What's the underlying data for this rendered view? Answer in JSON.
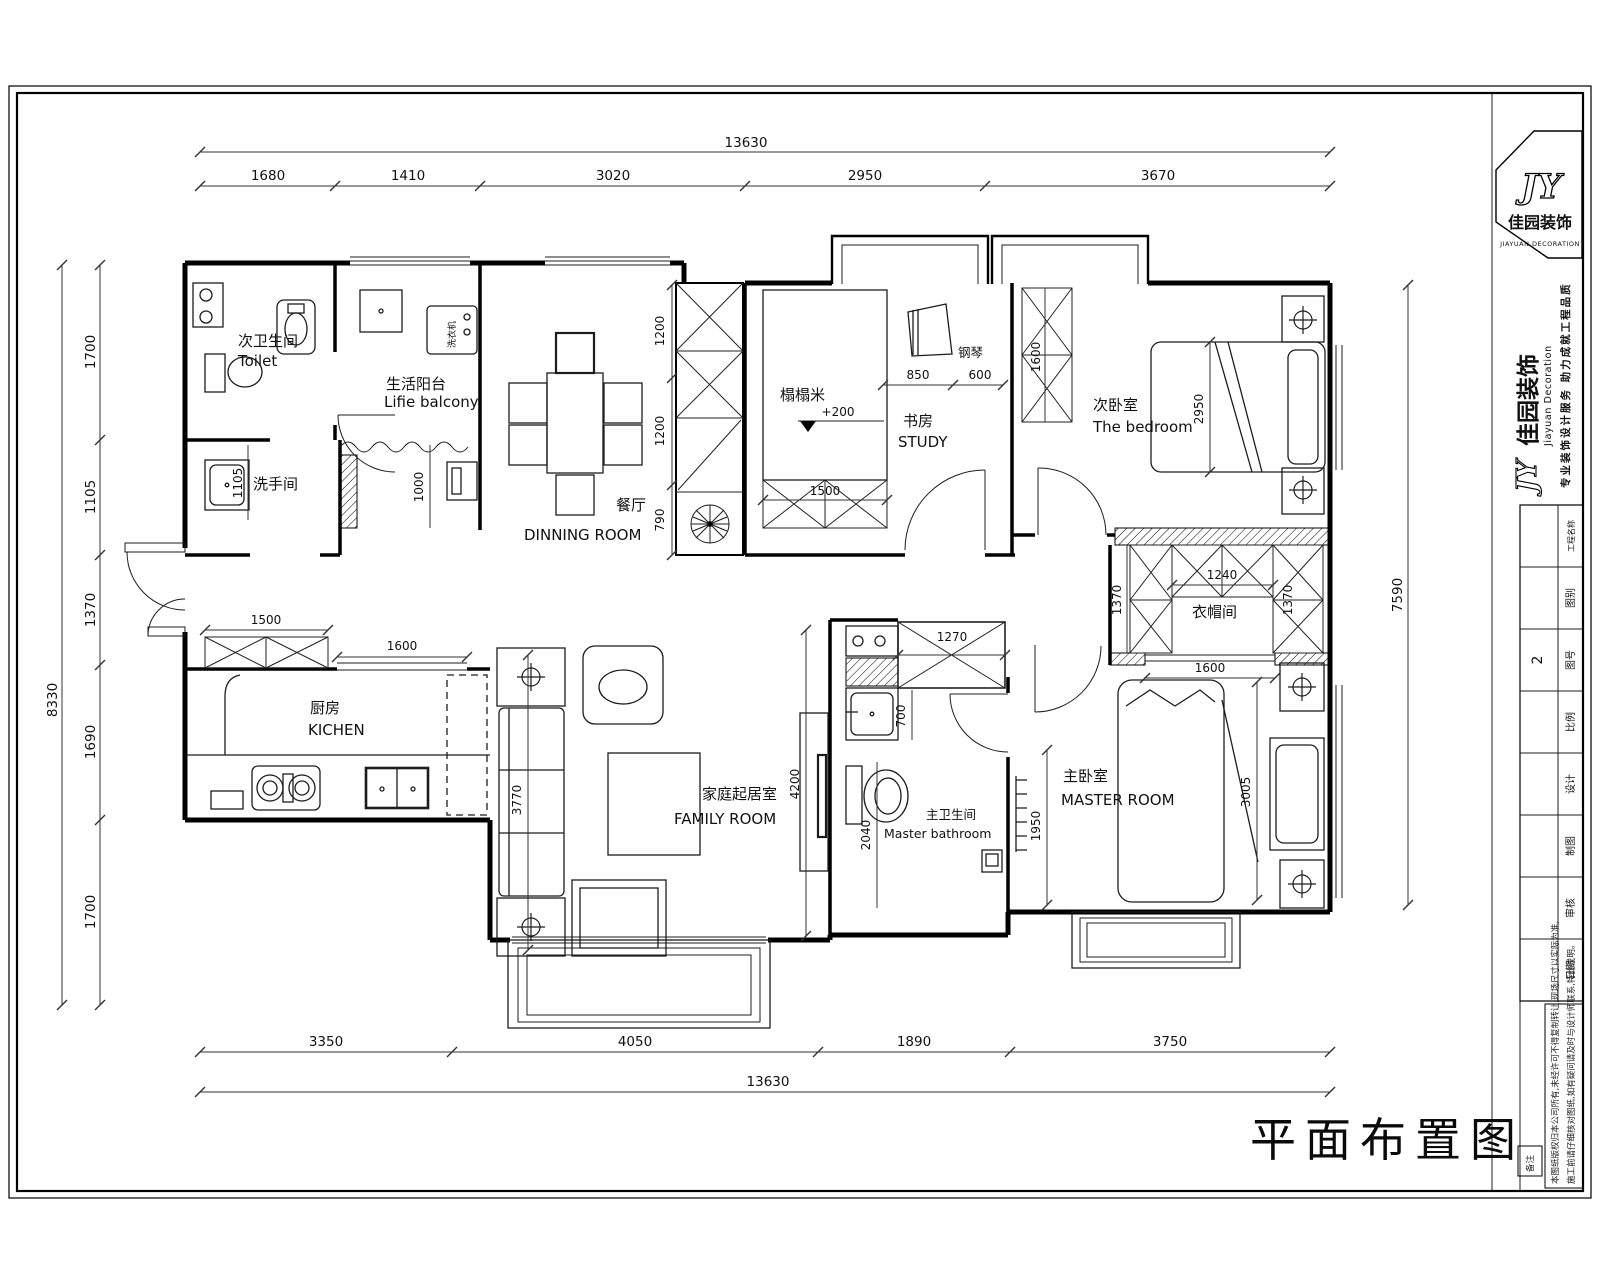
{
  "sheet": {
    "title": "平面布置图"
  },
  "logo": {
    "monogram": "JY",
    "name_cn": "佳园装饰",
    "name_en": "JIAYUAN DECORATION"
  },
  "brand": {
    "monogram": "JY",
    "name_cn": "佳园装饰",
    "name_en": "Jiayuan Decoration",
    "slogan": "专业装饰设计服务 助力成就工程品质"
  },
  "titleblock": {
    "rows": [
      {
        "label": "工程名称",
        "value": ""
      },
      {
        "label": "图别",
        "value": ""
      },
      {
        "label": "图号",
        "value": "2"
      },
      {
        "label": "比例",
        "value": ""
      },
      {
        "label": "设计",
        "value": ""
      },
      {
        "label": "制图",
        "value": ""
      },
      {
        "label": "审核",
        "value": ""
      },
      {
        "label": "日期",
        "value": ""
      }
    ],
    "note_box": "备注",
    "notes1": "本图纸版权归本公司所有,未经许可不得复制转让,现场尺寸以实际为准,",
    "notes2": "施工前请仔细核对图纸,如有疑问请及时与设计师联系,特此说明。"
  },
  "rooms": {
    "toilet_cn": "次卫生间",
    "toilet_en": "Toilet",
    "balcony_cn": "生活阳台",
    "balcony_en": "Lifie balcony",
    "washer": "洗衣机",
    "washroom_cn": "洗手间",
    "dining_cn": "餐厅",
    "dining_en": "DINNING ROOM",
    "study_cn": "书房",
    "study_en": "STUDY",
    "tatami": "榻榻米",
    "piano": "钢琴",
    "bedroom2_cn": "次卧室",
    "bedroom2_en": "The bedroom",
    "closet_cn": "衣帽间",
    "kitchen_cn": "厨房",
    "kitchen_en": "KICHEN",
    "family_cn": "家庭起居室",
    "family_en": "FAMILY ROOM",
    "mbath_cn": "主卫生间",
    "mbath_en": "Master bathroom",
    "master_cn": "主卧室",
    "master_en": "MASTER ROOM"
  },
  "dims": {
    "top_total": "13630",
    "top": [
      "1680",
      "1410",
      "3020",
      "2950",
      "3670"
    ],
    "bottom": [
      "3350",
      "4050",
      "1890",
      "3750"
    ],
    "bottom_total": "13630",
    "left_total": "8330",
    "left": [
      "1700",
      "1105",
      "1370",
      "1690",
      "1700"
    ],
    "right_total": "7590",
    "interior": {
      "stair1": "1200",
      "stair2": "1200",
      "stair3": "790",
      "wash": "1105",
      "balcony": "1000",
      "study_a": "850",
      "study_b": "600",
      "study_cab": "1500",
      "wardrobe": "1600",
      "window_bed2": "2950",
      "closet_top": "1240",
      "closet_left": "1370",
      "closet_right": "1370",
      "closet_door": "1600",
      "entry_cab": "1500",
      "kitchen_door": "1600",
      "sofa": "3770",
      "tv_wall": "4200",
      "bath_cab": "1270",
      "bath_sink": "700",
      "bath_wc": "2040",
      "master_left": "1950",
      "window_master": "3005",
      "tatami_level": "+200"
    }
  }
}
